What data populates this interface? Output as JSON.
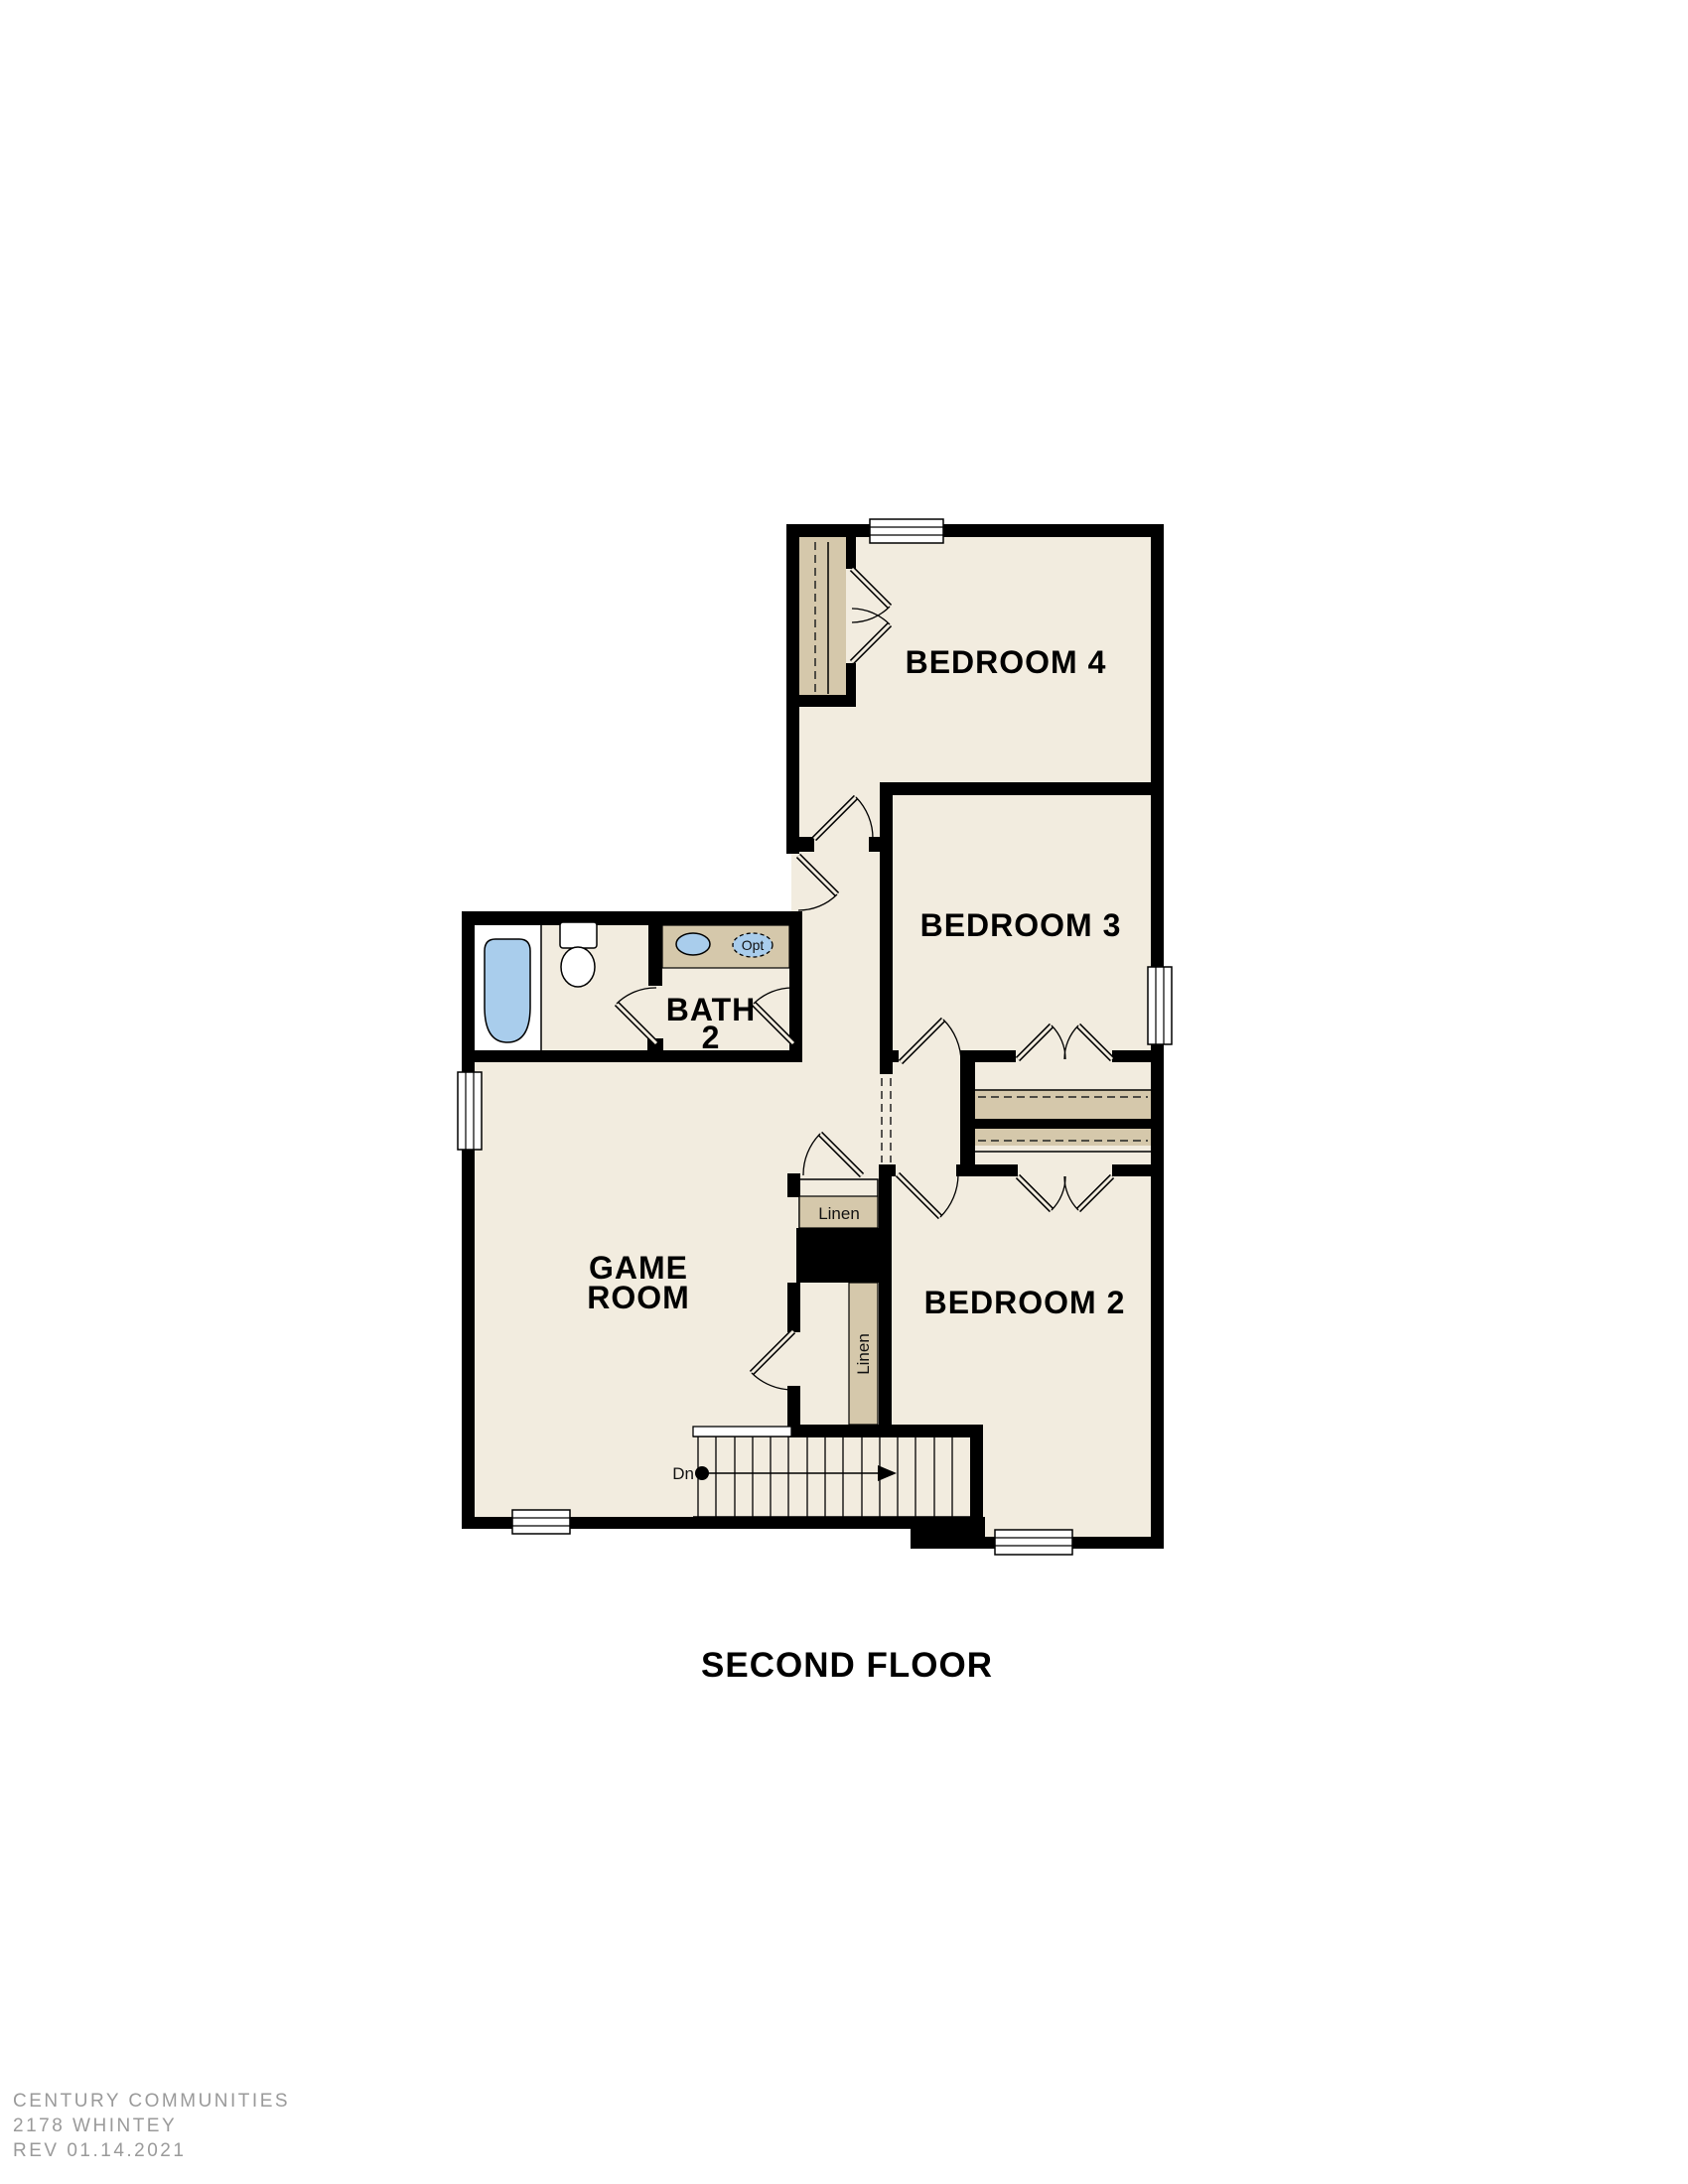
{
  "title": "SECOND FLOOR",
  "rooms": {
    "bedroom4": "BEDROOM 4",
    "bedroom3": "BEDROOM 3",
    "bedroom2": "BEDROOM 2",
    "bath_line1": "BATH",
    "bath_line2": "2",
    "game_line1": "GAME",
    "game_line2": "ROOM"
  },
  "closets": {
    "linen_horizontal": "Linen",
    "linen_vertical": "Linen"
  },
  "stairs": {
    "direction_label": "Dn"
  },
  "fixtures": {
    "optional_sink_label": "Opt"
  },
  "footer": {
    "line1": "CENTURY COMMUNITIES",
    "line2": "2178 WHINTEY",
    "line3": "REV 01.14.2021"
  },
  "colors": {
    "floor": "#f2ecdf",
    "closet_tan": "#d5c8ab",
    "fixture_blue": "#a9cdec",
    "wall": "#000000",
    "footer_gray": "#9a9a9a",
    "background": "#ffffff"
  }
}
